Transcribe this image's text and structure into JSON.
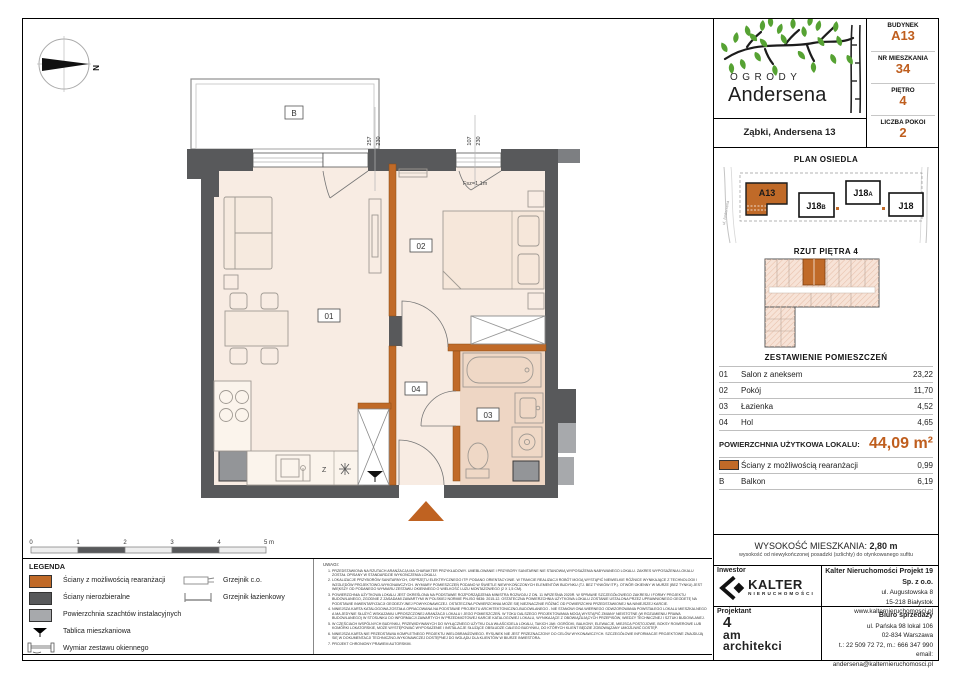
{
  "accent": "#bf5e1e",
  "header": {
    "logo_top": "OGRODY",
    "logo_main": "Andersena",
    "address": "Ząbki, Andersena 13",
    "info": [
      {
        "label": "BUDYNEK",
        "value": "A13"
      },
      {
        "label": "NR MIESZKANIA",
        "value": "34"
      },
      {
        "label": "PIĘTRO",
        "value": "4"
      },
      {
        "label": "LICZBA POKOI",
        "value": "2"
      }
    ]
  },
  "site_plan": {
    "title": "PLAN OSIEDLA",
    "street_left": "ul. Andersena",
    "buildings": {
      "a13": "A13",
      "j18b": {
        "main": "J18",
        "sub": "B"
      },
      "j18a": {
        "main": "J18",
        "sub": "A"
      },
      "j18": "J18"
    }
  },
  "floor_thumb": {
    "title": "RZUT PIĘTRA 4"
  },
  "rooms": {
    "title": "ZESTAWIENIE POMIESZCZEŃ",
    "rows": [
      {
        "no": "01",
        "name": "Salon z aneksem",
        "area": "23,22"
      },
      {
        "no": "02",
        "name": "Pokój",
        "area": "11,70"
      },
      {
        "no": "03",
        "name": "Łazienka",
        "area": "4,52"
      },
      {
        "no": "04",
        "name": "Hol",
        "area": "4,65"
      }
    ],
    "total_label": "POWIERZCHNIA UŻYTKOWA LOKALU:",
    "total_value": "44,09 m²",
    "walls_row": {
      "name": "Ściany z możliwością rearanżacji",
      "area": "0,99"
    },
    "balcony_row": {
      "no": "B",
      "name": "Balkon",
      "area": "6,19"
    }
  },
  "height": {
    "label": "WYSOKOŚĆ MIESZKANIA:",
    "value": "2,80 m",
    "note": "wysokość od niewykończonej posadzki (szlichty) do otynkowanego sufitu"
  },
  "plan": {
    "balcony": "B",
    "room01": "01",
    "room02": "02",
    "room03": "03",
    "room04": "04",
    "dim_left_a": "257",
    "dim_left_b": "230",
    "dim_right_a": "107",
    "dim_right_b": "230",
    "parapet": "Fsz=1,1m",
    "north": "N",
    "sink": "Z",
    "scale": [
      "0",
      "1",
      "2",
      "3",
      "4",
      "5 m"
    ]
  },
  "legend": {
    "title": "LEGENDA",
    "items": [
      "Ściany z możliwością rearanżacji",
      "Ściany nierozbieralne",
      "Powierzchnia szachtów instalacyjnych",
      "Tablica mieszkaniowa",
      "Wymiar zestawu okiennego"
    ],
    "items2": [
      "Grzejnik c.o.",
      "Grzejnik łazienkowy"
    ]
  },
  "notes": {
    "title": "UWAGI:",
    "items": [
      "PRZEDSTAWIONA NA RZUTACH ARANŻACJA MA CHARAKTER PRZYKŁADOWY. UMEBLOWANIE I PRZYBORY SANITARNE NIE STANOWIĄ WYPOSAŻENIA NABYWANEGO LOKALU. ZAKRES WYPOSAŻENIA LOKALU ZOSTAŁ OPISANY W STANDARDZIE WYKOŃCZENIA LOKALU.",
      "LOKALIZACJE PRZYBORÓW SANITARNYCH, OSPRZĘTU ELEKTRYCZNEGO ITP. PODANO ORIENTACYJNIE. W TRAKCIE REALIZACJI ROBÓT MOGĄ WYSTĄPIĆ NIEWIELKIE RÓŻNICE WYNIKAJĄCE Z TECHNOLOGII I WZGLĘDÓW PROJEKTOWO-WYKONAWCZYCH. WYMIARY POMIESZCZEŃ PODANO W ŚWIETLE NIEWYKOŃCZONYCH ELEMENTÓW BUDYNKU (TJ. BEZ TYNKÓW ITP.). OTWÓR OKIENNY W MURZE (BEZ TYNKU) JEST WIĘKSZY OD PODANEGO WYMIARU ZESTAWU OKIENNEGO O WIELKOŚĆ LUZU MONTAŻOWEGO (2 X 1,5 CM).",
      "POWIERZCHNIA UŻYTKOWA LOKALU JEST OKREŚLONA NA PODSTAWIE ROZPORZĄDZENIA MINISTRA ROZWOJU Z DN. 11 WRZEŚNIA 2020R. W SPRAWIE SZCZEGÓŁOWEGO ZAKRESU I FORMY PROJEKTU BUDOWLANEGO, ZGODNIE Z ZASADAMI ZAWARTYMI W POLSKIEJ NORMIE PN-ISO 9836: 2015-12. OSTATECZNA POWIERZCHNIA UŻYTKOWA LOKALU ZOSTANIE USTALONA PRZEZ UPRAWNIONEGO GEODETĘ NA PODSTAWIE INWENTARYZACJI GEODEZYJNEJ POWYKONAWCZEJ. OSTATECZNA POWIERZCHNIA MOŻE SIĘ NIEZNACZNIE RÓŻNIĆ OD POWIERZCHNI PRZEDSTAWIONEJ NA NINIEJSZEJ KARCIE.",
      "NINIEJSZA KARTA KATALOGOWA ZOSTAŁA OPRACOWANA NA PODSTAWIE PROJEKTU ARCHITEKTONICZNO-BUDOWLANEGO - NIE STANOWI ONA WIERNEGO ODWZOROWANIA POWSTAŁEGO LOKALU MIESZKALNEGO A MA JEDYNIE SŁUŻYĆ WSKAZANIU UPROSZCZONEJ ARANŻACJI LOKALU I JEGO POMIESZCZEŃ. W TOKU DALSZEGO PROJEKTOWANIA MOGĄ WYSTĄPIĆ ZMIANY NIEISTOTNE (W ROZUMIENIU PRAWA BUDOWLANEGO) W STOSUNKU DO INFORMACJI ZAWARTYCH W PRZEDMIOTOWEJ KARCIE KATALOGOWEJ LOKALU, WYNIKAJĄCE Z OBOWIĄZUJĄCYCH PRZEPISÓW, WIEDZY TECHNICZNEJ I SZTUKI BUDOWLANEJ.",
      "W CZĘŚCIACH WSPÓLNYCH BUDYNKU, PRZEWIDYWANYCH DO WYŁĄCZNEGO UŻYTKU DLA WŁAŚCICIELA LOKALU, TAKICH JAK: OGRÓDKI, BALKONY, ELEWACJE, MIEJSCA POSTOJOWE, BOKSY ROWEROWE LUB KOMÓRKI LOKATORSKIE, MOŻE WYSTĘPOWAĆ WYPOSAŻENIE I INSTALACJE SŁUŻĄCE OBSŁUDZE CAŁEGO BUDYNKU, DO KTÓRYCH KLIENT BĘDZIE ZOBOWIĄZANY UMOŻLIWIĆ DOSTĘP.",
      "NINIEJSZA KARTA NIE PRZEDSTAWIA KOMPLETNEGO PROJEKTU WIELOBRANŻOWEGO. RYSUNEK NIE JEST PRZEZNACZONY DO CELÓW WYKONAWCZYCH. SZCZEGÓŁOWE INFORMACJE PROJEKTOWE ZNAJDUJĄ SIĘ W DOKUMENTACJI TECHNICZNO-WYKONAWCZEJ DOSTĘPNEJ DO WGLĄDU DLA KLIENTÓW W BIURZE INWESTORA.",
      "PROJEKT CHRONIONY PRAWEM AUTORSKIM."
    ]
  },
  "footer": {
    "investor_label": "Inwestor",
    "investor_logo_main": "KALTER",
    "investor_logo_sub": "NIERUCHOMOŚCI",
    "company_name": "Kalter Nieruchomości Projekt 19 Sp. z o.o.",
    "company_lines": [
      "ul. Augustowska 8",
      "15-218 Białystok",
      "www.kalternieruchomosci.pl"
    ],
    "designer_label": "Projektant",
    "designer_logo": [
      "4",
      "am",
      "architekci"
    ],
    "sales_title": "Biuro sprzedaży",
    "sales_lines": [
      "ul. Pańska 98 lokal 106",
      "02-834 Warszawa",
      "t.: 22 509 72 72, m.: 666 347 990",
      "email: andersena@kalternieruchomosci.pl"
    ]
  }
}
